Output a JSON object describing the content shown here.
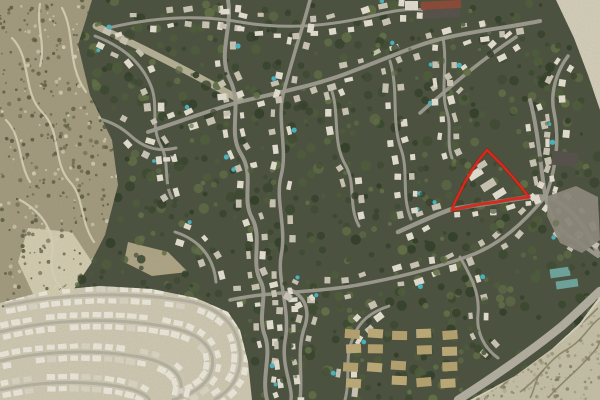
{
  "map": {
    "canvas": {
      "width": 600,
      "height": 400
    },
    "palette": {
      "forest_base": "#4d5340",
      "tree_deep": "#33402a",
      "tree_dark": "#3c4930",
      "tree_mid": "#4f5e3b",
      "tree_light": "#637247",
      "scrubland": "#a69e81",
      "scrub_trail": "#ddd6bc",
      "scrub_speckle_dark": "#5d5e44",
      "scrub_speckle_light": "#d9d3ba",
      "scrub_bright": "#d7d0b4",
      "dirt": "#b2a889",
      "dev_ground": "#d3ccb6",
      "dev_house": "#f0ece0",
      "dev_house_alt": "#ded9c8",
      "rocky": "#c9c3ab",
      "rocky_crevice": "#857e5f",
      "rocky_speckle": "#a59e82",
      "rocky_ridge": "#ded8c1",
      "barren": "#d8d2bd",
      "road": "#a3a096",
      "road_major": "#b6b2a4",
      "trail_main": "#cdc5a9",
      "house_light": "#e9e4d6",
      "house_mid": "#cfc9b9",
      "pool": "#49b9c8",
      "apartment": "#c2ae7b",
      "apartment_alt": "#b9a572",
      "parking": "#8f8b80",
      "building_dark": "#57524c",
      "building_red": "#8f4a38",
      "building_white": "#e5e1d4",
      "greenhouse": "#6fa8a0",
      "annotation": "#d8291a",
      "annotation_shadow": "#8f150c"
    },
    "regions": {
      "scrubland": [
        [
          0,
          0
        ],
        [
          92,
          0
        ],
        [
          78,
          45
        ],
        [
          90,
          95
        ],
        [
          112,
          140
        ],
        [
          118,
          185
        ],
        [
          105,
          235
        ],
        [
          88,
          268
        ],
        [
          50,
          296
        ],
        [
          0,
          308
        ]
      ],
      "development": [
        [
          0,
          303
        ],
        [
          45,
          291
        ],
        [
          100,
          286
        ],
        [
          152,
          289
        ],
        [
          196,
          298
        ],
        [
          228,
          312
        ],
        [
          240,
          330
        ],
        [
          248,
          362
        ],
        [
          252,
          400
        ],
        [
          0,
          400
        ]
      ],
      "rocky": [
        [
          600,
          296
        ],
        [
          600,
          400
        ],
        [
          470,
          400
        ],
        [
          515,
          376
        ],
        [
          552,
          349
        ],
        [
          580,
          323
        ]
      ],
      "barren_tr": [
        [
          556,
          0
        ],
        [
          600,
          0
        ],
        [
          600,
          110
        ],
        [
          588,
          75
        ],
        [
          574,
          38
        ]
      ],
      "scrub_bright": [
        [
          28,
          228
        ],
        [
          72,
          232
        ],
        [
          92,
          262
        ],
        [
          70,
          295
        ],
        [
          34,
          296
        ],
        [
          18,
          262
        ]
      ],
      "dirt_patch": [
        [
          128,
          242
        ],
        [
          168,
          252
        ],
        [
          188,
          272
        ],
        [
          152,
          276
        ],
        [
          124,
          262
        ]
      ],
      "parking_lot": [
        [
          548,
          196
        ],
        [
          576,
          186
        ],
        [
          598,
          197
        ],
        [
          600,
          240
        ],
        [
          582,
          253
        ],
        [
          560,
          243
        ],
        [
          547,
          216
        ]
      ]
    },
    "trails": {
      "main": "M96,26 C130,42 170,62 200,78 C215,86 228,93 240,100",
      "scrub": [
        "M12,38 C32,58 22,92 42,112 C62,132 52,162 70,182 C84,196 80,222 94,242",
        "M62,8 C76,34 66,64 86,92",
        "M20,200 C42,212 56,232 52,256 C48,276 62,292 76,302",
        "M6,120 C22,136 18,162 30,182",
        "M40,4 C36,26 46,44 40,66"
      ]
    },
    "roads": [
      {
        "d": "M228,0 C233,28 217,54 230,80 C243,106 227,132 241,154 C255,176 241,198 252,218 C263,238 250,262 261,282 C268,296 257,316 265,336 C272,356 261,376 267,400",
        "w": 4
      },
      {
        "d": "M310,0 C301,34 291,62 283,95 C277,121 288,150 281,176 C275,201 287,227 281,256 C277,281 291,311 285,341 C281,366 293,386 291,400",
        "w": 3.5
      },
      {
        "d": "M148,132 C190,118 216,108 243,101 C281,92 321,84 353,71 C386,59 416,44 449,37 C481,30 511,27 540,21",
        "w": 4
      },
      {
        "d": "M420,113 C451,86 481,60 516,37",
        "w": 3.5
      },
      {
        "d": "M398,232 C424,220 440,213 452,209 C478,205 504,201 529,197 C546,194 560,201 572,213 C584,225 592,241 598,253",
        "w": 4.5
      },
      {
        "d": "M546,196 C556,168 560,140 554,112 C550,94 556,72 568,56",
        "w": 3.5
      },
      {
        "d": "M230,300 C272,291 312,293 352,286 C392,279 432,269 466,257 C500,246 526,220 545,197",
        "w": 3.5
      },
      {
        "d": "M300,400 C303,374 296,350 305,326 C311,306 302,295 289,289",
        "w": 3.5
      },
      {
        "d": "M345,400 C351,377 344,357 353,338 C359,321 371,312 389,306",
        "w": 3
      },
      {
        "d": "M330,86 C341,112 331,141 346,166 C356,184 348,206 359,226",
        "w": 3
      },
      {
        "d": "M390,61 C399,91 391,121 401,149 C409,171 401,196 411,219",
        "w": 3
      },
      {
        "d": "M95,36 C121,46 141,61 151,86 C159,106 150,126 161,146 C170,162 163,182 172,198",
        "w": 3
      },
      {
        "d": "M58,122 C85,112 111,118 131,136 C145,149 160,152 176,148",
        "w": 3
      },
      {
        "d": "M443,38 C448,66 440,90 447,112 C452,128 446,142 452,158",
        "w": 3
      },
      {
        "d": "M175,232 C200,240 214,258 216,282",
        "w": 3
      },
      {
        "d": "M460,257 C470,275 480,292 478,314 C476,332 484,348 498,358",
        "w": 3
      },
      {
        "d": "M108,28 C150,18 195,14 240,22 C285,30 330,26 372,16 C392,11 408,8 424,10",
        "w": 3
      },
      {
        "d": "M530,100 C538,130 540,162 545,194 C548,212 556,228 572,238 C584,246 592,252 598,256",
        "w": 4
      }
    ],
    "dev_arcs": [
      "M4,306 C62,293 132,291 192,302 C224,310 238,328 240,352 C242,374 232,390 214,400",
      "M0,332 C52,319 114,317 168,327 C200,333 216,348 212,368 C209,384 194,394 172,400",
      "M0,361 C42,351 94,349 140,357 C172,363 186,376 180,396",
      "M0,390 C36,382 78,380 116,386 C134,389 146,394 150,400"
    ],
    "major_road": "M458,400 C492,378 530,352 562,326 C578,312 590,300 600,291",
    "rocky_ridge": "M470,400 C515,376 552,349 580,323 L600,297",
    "rocky_cracks": [
      "M520,392 C540,378 548,360 566,350 C584,340 590,324 600,318",
      "M548,398 C562,382 576,372 588,358 C596,350 600,344 600,340",
      "M500,388 C516,374 522,360 538,350",
      "M560,336 C576,330 588,318 598,308",
      "M530,398 C536,388 534,378 544,370"
    ],
    "apartments": {
      "x": 352,
      "y": 334,
      "cols": 5,
      "rows": 4,
      "dx": 24,
      "dy": 16,
      "w": 15,
      "h": 9
    },
    "buildings": [
      {
        "x": 421,
        "y": 1,
        "w": 40,
        "h": 8,
        "fill": "building_red",
        "rot": -3
      },
      {
        "x": 423,
        "y": 9,
        "w": 37,
        "h": 9,
        "fill": "building_dark",
        "rot": -3
      },
      {
        "x": 405,
        "y": 1,
        "w": 13,
        "h": 9,
        "fill": "building_white",
        "rot": 0
      },
      {
        "x": 552,
        "y": 152,
        "w": 26,
        "h": 14,
        "fill": "building_dark",
        "rot": 6
      },
      {
        "x": 550,
        "y": 268,
        "w": 20,
        "h": 9,
        "fill": "greenhouse",
        "rot": -8
      },
      {
        "x": 556,
        "y": 280,
        "w": 22,
        "h": 8,
        "fill": "greenhouse",
        "rot": -8
      },
      {
        "x": 468,
        "y": 170,
        "w": 15,
        "h": 8,
        "fill": "house_light",
        "rot": -32
      },
      {
        "x": 481,
        "y": 181,
        "w": 15,
        "h": 8,
        "fill": "house_mid",
        "rot": -32
      },
      {
        "x": 493,
        "y": 190,
        "w": 13,
        "h": 7,
        "fill": "house_light",
        "rot": -32
      },
      {
        "x": 477,
        "y": 162,
        "w": 10,
        "h": 6,
        "fill": "house_mid",
        "rot": -32
      }
    ],
    "annotation": {
      "label": "Highlighted parcel boundary",
      "stroke_width": 2.4,
      "points": [
        [
          487,
          150
        ],
        [
          479,
          160
        ],
        [
          472,
          170
        ],
        [
          465,
          182
        ],
        [
          459,
          194
        ],
        [
          455,
          202
        ],
        [
          452,
          210
        ],
        [
          466,
          207
        ],
        [
          481,
          204
        ],
        [
          497,
          202
        ],
        [
          513,
          199
        ],
        [
          529,
          197
        ],
        [
          521,
          187
        ],
        [
          512,
          176
        ],
        [
          502,
          165
        ],
        [
          494,
          157
        ],
        [
          487,
          150
        ]
      ]
    }
  }
}
